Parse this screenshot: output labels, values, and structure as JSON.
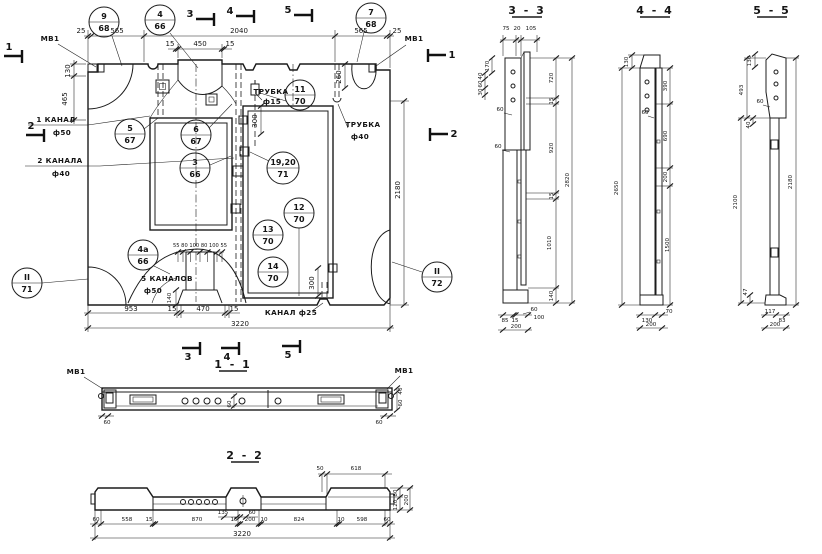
{
  "plan": {
    "callouts": {
      "c9": {
        "num": "9",
        "sheet": "68"
      },
      "c4": {
        "num": "4",
        "sheet": "66"
      },
      "c7": {
        "num": "7",
        "sheet": "68"
      },
      "c5": {
        "num": "5",
        "sheet": "67"
      },
      "c6": {
        "num": "6",
        "sheet": "67"
      },
      "c3": {
        "num": "3",
        "sheet": "66"
      },
      "c11": {
        "num": "11",
        "sheet": "70"
      },
      "c1920": {
        "num": "19,20",
        "sheet": "71"
      },
      "c12": {
        "num": "12",
        "sheet": "70"
      },
      "c13": {
        "num": "13",
        "sheet": "70"
      },
      "c14": {
        "num": "14",
        "sheet": "70"
      },
      "c4a": {
        "num": "4а",
        "sheet": "66"
      },
      "cII71": {
        "num": "II",
        "sheet": "71"
      },
      "cII72": {
        "num": "II",
        "sheet": "72"
      }
    },
    "labels": {
      "mv1_left": "МВ1",
      "mv1_right": "МВ1",
      "tube15_name": "ТРУБКА",
      "tube15_dia": "ф15",
      "tube40_name": "ТРУБКА",
      "tube40_dia": "ф40",
      "canal1_name": "1 КАНАЛ",
      "canal1_dia": "ф50",
      "canal2_name": "2 КАНАЛА",
      "canal2_dia": "ф40",
      "canal5_name": "5 КАНАЛОВ",
      "canal5_dia": "ф50",
      "canal25": "КАНАЛ ф25"
    },
    "markers": {
      "m1": "1",
      "m2": "2",
      "m3": "3",
      "m4": "4",
      "m5": "5"
    },
    "dims": {
      "top25l": "25",
      "top565l": "565",
      "top2040": "2040",
      "top15a": "15",
      "top450": "450",
      "top15b": "15",
      "top565r": "565",
      "top25r": "25",
      "left130": "130",
      "left465": "465",
      "right260": "260",
      "right2180": "2180",
      "mid300a": "300",
      "mid300b": "300",
      "bot953": "953",
      "bot15a": "15",
      "bot470": "470",
      "bot15b": "15",
      "bot3220": "3220",
      "fanrow": "55 80 100 80 100 55",
      "fan140": "140"
    }
  },
  "sections": {
    "s11": {
      "title": "1 - 1",
      "mv1_left": "МВ1",
      "mv1_right": "МВ1",
      "d60l": "60",
      "d60c": "60",
      "d60r": "60",
      "d40": "40",
      "d60v": "60"
    },
    "s22": {
      "title": "2 - 2",
      "d50": "50",
      "d618": "618",
      "d80": "80",
      "d200r": "200",
      "d120": "120",
      "d135": "135",
      "d60aux": "60",
      "bottom": [
        "60",
        "558",
        "15",
        "870",
        "15",
        "200",
        "10",
        "824",
        "10",
        "598",
        "60"
      ],
      "total": "3220"
    },
    "s33": {
      "title": "3 - 3",
      "top": [
        "75",
        "20",
        "105"
      ],
      "d170": "170",
      "d40": "40",
      "d60a": "60",
      "d30": "30",
      "d60b": "60",
      "d60c": "60",
      "right": [
        "720",
        "15",
        "920",
        "15",
        "1010",
        "140"
      ],
      "d2820": "2820",
      "d85": "85",
      "d15": "15",
      "d60d": "60",
      "d100": "100",
      "d200": "200"
    },
    "s44": {
      "title": "4 - 4",
      "d130t": "130",
      "d60": "60",
      "d2650": "2650",
      "right": [
        "390",
        "690",
        "200",
        "1500"
      ],
      "d130b": "130",
      "d70": "70",
      "d200": "200"
    },
    "s55": {
      "title": "5 - 5",
      "d130": "130",
      "d493": "493",
      "d60": "60",
      "d40": "40",
      "d2100": "2100",
      "d47": "47",
      "d2180": "2180",
      "d117": "117",
      "d83": "83",
      "d200": "200"
    }
  }
}
